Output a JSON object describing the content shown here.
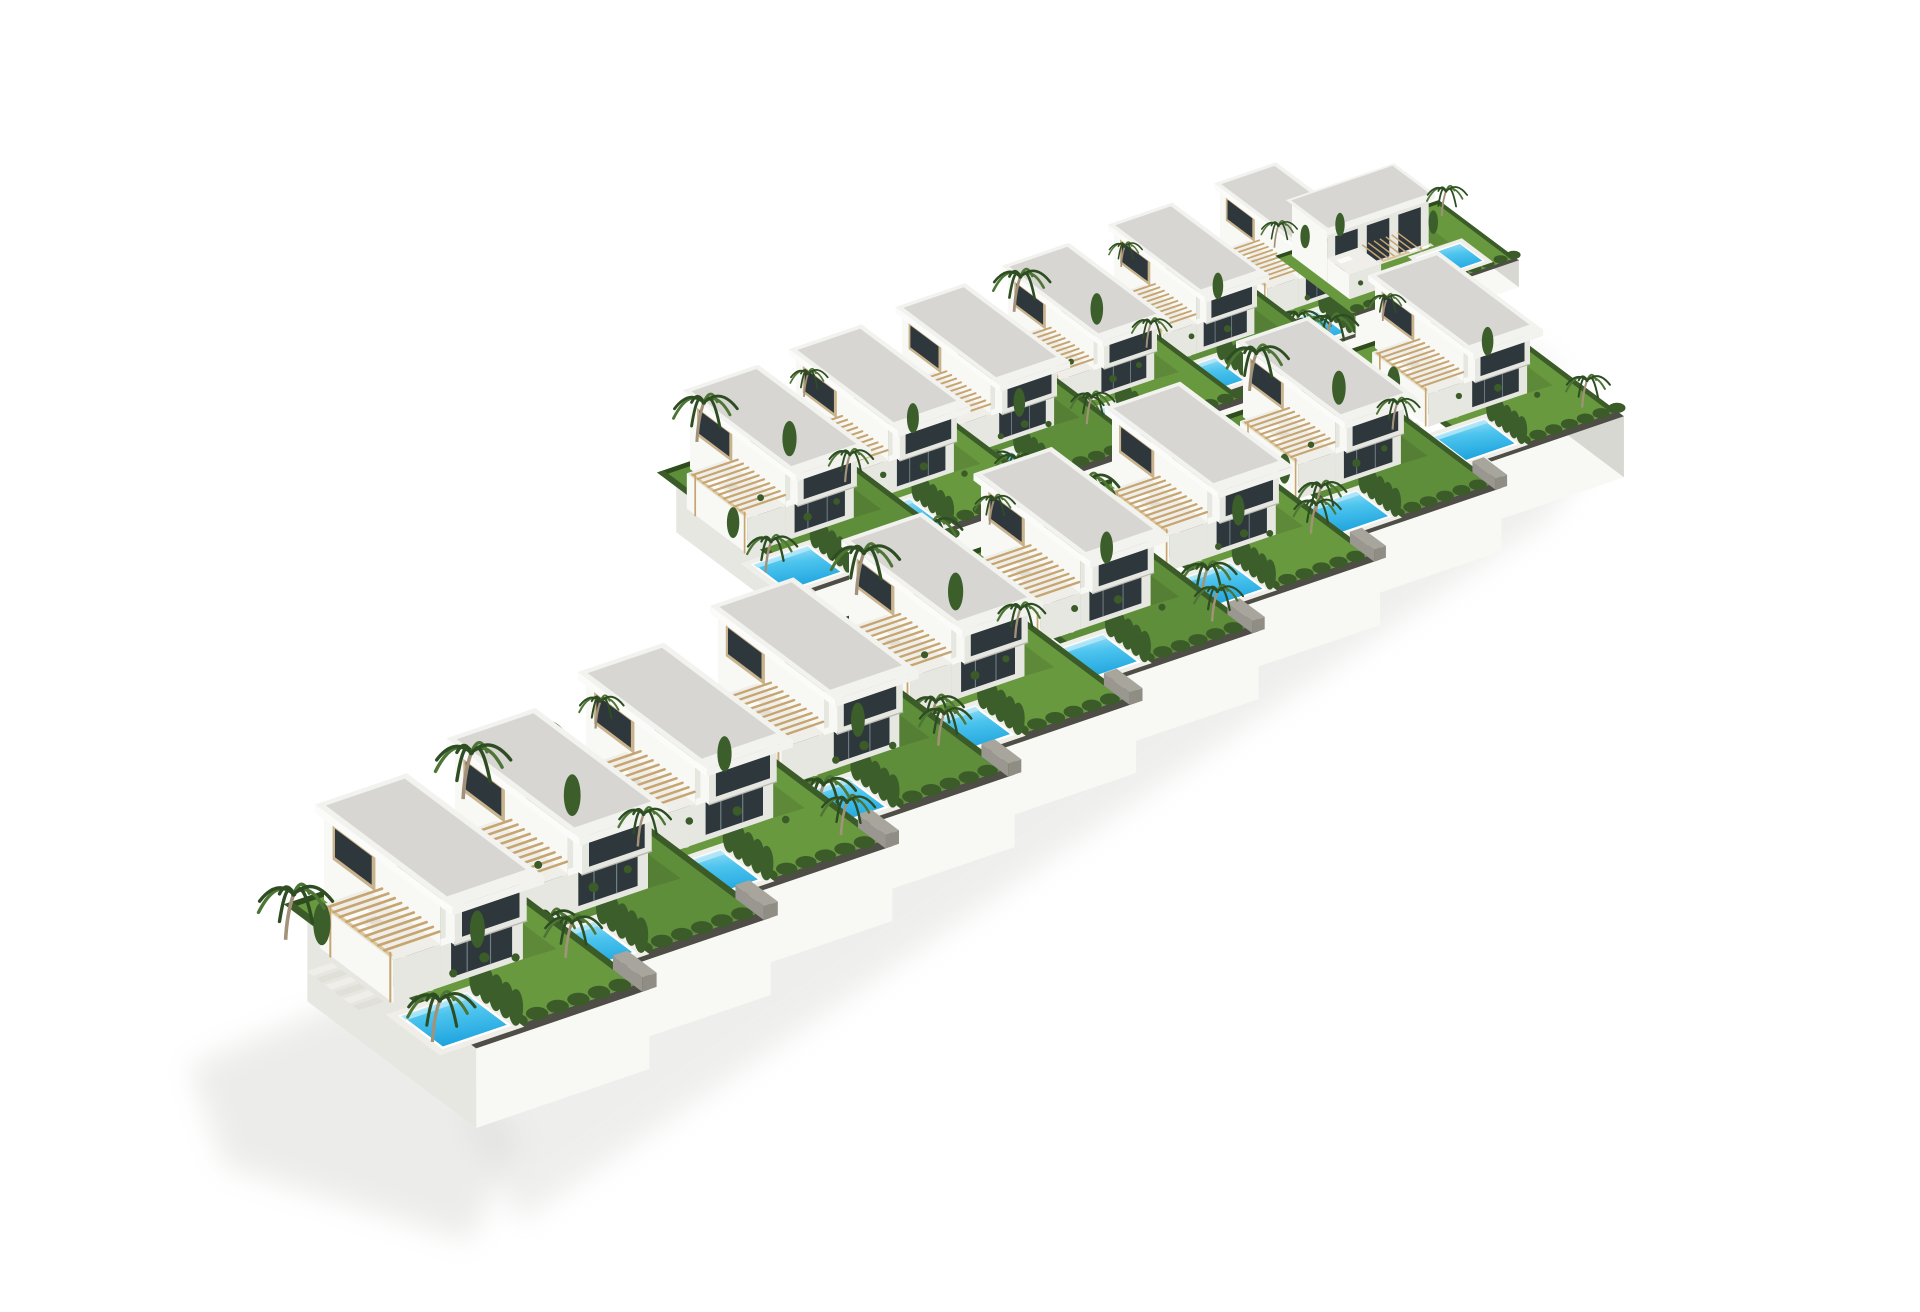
{
  "meta": {
    "description": "Aerial 3D architectural rendering of a terraced residential development on a white background: 16 modern white flat-roof villas arranged in two diagonal rows, each villa with a private garden, turquoise swimming pool, wooden pergola, roof terrace with white furniture, cypress hedges and palm trees, bounded by white retaining walls casting a soft shadow."
  },
  "scene": {
    "canvas": {
      "width": 1920,
      "height": 1280,
      "background": "#ffffff"
    },
    "axes": {
      "U": [
        0.88,
        -0.3
      ],
      "V": [
        0.6,
        0.45
      ]
    },
    "counts": {
      "villas": 16,
      "pools": 16,
      "front_row": 9,
      "back_row": 6,
      "rotated": 1
    },
    "colors": {
      "lawn_a": "#68993f",
      "lawn_b": "#5e8e3a",
      "hedge": "#3b5b29",
      "hedge_dark": "#2f4c1f",
      "cypress": "#3c5e2b",
      "palm_dark": "#2e4d23",
      "palm_mid": "#4d7534",
      "trunk": "#a3927a",
      "roof_gravel": "#d7d6d2",
      "parapet": "#f2f2ef",
      "wall_bright": "#f8f8f5",
      "wall_shade": "#e7e7e2",
      "wall_dark": "#d8d8d2",
      "glass": "#2e373b",
      "glass_light": "#8aa0a8",
      "frame": "#c8b38d",
      "deck": "#efeee8",
      "white": "#fbfbf9",
      "white_dim": "#e0dfd8",
      "pool_light": "#b5e8f8",
      "pool_mid": "#4cc4ee",
      "pool_deep": "#1ea4de",
      "wood": "#c7a571",
      "wood_light": "#ddc393",
      "gray_wall": "#8f8d84",
      "gray_wall_side": "#999790",
      "gray_wall_top": "#a7a59c",
      "gravel_strip": "#4e4e46",
      "shadow": "#d6d6d3"
    },
    "shadows": [
      {
        "points": [
          [
            150,
            1050
          ],
          [
            330,
            975
          ],
          [
            480,
            1120
          ],
          [
            430,
            1225
          ],
          [
            185,
            1150
          ]
        ],
        "opacity": 0.45
      },
      {
        "points": [
          [
            420,
            1095
          ],
          [
            1450,
            400
          ],
          [
            1550,
            445
          ],
          [
            1505,
            505
          ],
          [
            480,
            1205
          ]
        ],
        "opacity": 0.4
      },
      {
        "points": [
          [
            1380,
            305
          ],
          [
            1505,
            335
          ],
          [
            1530,
            375
          ],
          [
            1420,
            355
          ]
        ],
        "opacity": 0.28
      }
    ],
    "flora_sets": {
      "A": {
        "palms": [
          [
            -70,
            40,
            44
          ],
          [
            126,
            210,
            34
          ],
          [
            -62,
            268,
            40
          ]
        ],
        "cypress": [
          [
            -46,
            64,
            16
          ],
          [
            70,
            148,
            14
          ]
        ],
        "bushes": [
          [
            64,
            168,
            5
          ],
          [
            24,
            176,
            4
          ],
          [
            88,
            184,
            4
          ]
        ]
      },
      "B": {
        "palms": [
          [
            40,
            -45,
            46
          ],
          [
            128,
            120,
            32
          ],
          [
            -58,
            235,
            36
          ]
        ],
        "cypress": [
          [
            110,
            36,
            16
          ],
          [
            -44,
            150,
            14
          ]
        ],
        "bushes": [
          [
            50,
            160,
            5
          ],
          [
            96,
            150,
            4
          ],
          [
            30,
            96,
            4
          ]
        ]
      },
      "C": {
        "palms": [
          [
            -55,
            -25,
            40
          ],
          [
            128,
            255,
            34
          ],
          [
            44,
            -48,
            28
          ]
        ],
        "cypress": [
          [
            -48,
            110,
            16
          ],
          [
            104,
            88,
            14
          ]
        ],
        "bushes": [
          [
            70,
            160,
            5
          ],
          [
            20,
            150,
            4
          ],
          [
            100,
            200,
            4
          ]
        ]
      },
      "R": {
        "palms": [
          [
            248,
            26,
            38
          ],
          [
            64,
            176,
            30
          ],
          [
            -8,
            -34,
            34
          ]
        ],
        "cypress": [
          [
            30,
            -10,
            14
          ],
          [
            92,
            -10,
            14
          ],
          [
            210,
            60,
            14
          ]
        ],
        "bushes": [
          [
            120,
            170,
            5
          ],
          [
            40,
            120,
            4
          ]
        ]
      }
    },
    "villas": [
      {
        "id": "f0",
        "row": "front",
        "type": "standard",
        "anchor": [
          284,
          884
        ],
        "scale": 1.02,
        "wall_h": 78,
        "left_wall": true,
        "right_wall": false,
        "lawn": "a",
        "flora": "A"
      },
      {
        "id": "f1",
        "row": "front",
        "type": "standard",
        "anchor": [
          415,
          815
        ],
        "scale": 0.99,
        "wall_h": 78,
        "left_wall": false,
        "right_wall": false,
        "lawn": "b",
        "flora": "B"
      },
      {
        "id": "f2",
        "row": "front",
        "type": "standard",
        "anchor": [
          546,
          746
        ],
        "scale": 0.96,
        "wall_h": 78,
        "left_wall": false,
        "right_wall": false,
        "lawn": "a",
        "flora": "C"
      },
      {
        "id": "f3",
        "row": "front",
        "type": "standard",
        "anchor": [
          678,
          677
        ],
        "scale": 0.93,
        "wall_h": 78,
        "left_wall": false,
        "right_wall": false,
        "lawn": "b",
        "flora": "A"
      },
      {
        "id": "f4",
        "row": "front",
        "type": "standard",
        "anchor": [
          809,
          608
        ],
        "scale": 0.9,
        "wall_h": 78,
        "left_wall": false,
        "right_wall": false,
        "lawn": "a",
        "flora": "B"
      },
      {
        "id": "f5",
        "row": "front",
        "type": "standard",
        "anchor": [
          941,
          539
        ],
        "scale": 0.87,
        "wall_h": 78,
        "left_wall": false,
        "right_wall": false,
        "lawn": "b",
        "flora": "C"
      },
      {
        "id": "f6",
        "row": "front",
        "type": "standard",
        "anchor": [
          1072,
          470
        ],
        "scale": 0.84,
        "wall_h": 78,
        "left_wall": false,
        "right_wall": false,
        "lawn": "a",
        "flora": "A"
      },
      {
        "id": "f7",
        "row": "front",
        "type": "standard",
        "anchor": [
          1203,
          401
        ],
        "scale": 0.81,
        "wall_h": 78,
        "left_wall": false,
        "right_wall": false,
        "lawn": "b",
        "flora": "B"
      },
      {
        "id": "f8",
        "row": "front",
        "type": "standard",
        "anchor": [
          1335,
          332
        ],
        "scale": 0.78,
        "wall_h": 78,
        "left_wall": false,
        "right_wall": true,
        "lawn": "a",
        "flora": "C"
      },
      {
        "id": "b0",
        "row": "back",
        "type": "standard",
        "anchor": [
          650,
          453
        ],
        "scale": 0.84,
        "wall_h": 54,
        "left_wall": true,
        "right_wall": false,
        "lawn": "b",
        "flora": "B"
      },
      {
        "id": "b1",
        "row": "back",
        "type": "standard",
        "anchor": [
          756,
          409
        ],
        "scale": 0.81,
        "wall_h": 54,
        "left_wall": false,
        "right_wall": false,
        "lawn": "a",
        "flora": "C"
      },
      {
        "id": "b2",
        "row": "back",
        "type": "standard",
        "anchor": [
          862,
          364
        ],
        "scale": 0.78,
        "wall_h": 54,
        "left_wall": false,
        "right_wall": false,
        "lawn": "b",
        "flora": "A"
      },
      {
        "id": "b3",
        "row": "back",
        "type": "standard",
        "anchor": [
          968,
          320
        ],
        "scale": 0.75,
        "wall_h": 54,
        "left_wall": false,
        "right_wall": false,
        "lawn": "a",
        "flora": "B"
      },
      {
        "id": "b4",
        "row": "back",
        "type": "standard",
        "anchor": [
          1074,
          276
        ],
        "scale": 0.72,
        "wall_h": 54,
        "left_wall": false,
        "right_wall": false,
        "lawn": "b",
        "flora": "C"
      },
      {
        "id": "b5",
        "row": "back",
        "type": "standard",
        "anchor": [
          1180,
          232
        ],
        "scale": 0.69,
        "wall_h": 54,
        "left_wall": false,
        "right_wall": false,
        "lawn": "a",
        "flora": "A"
      },
      {
        "id": "r0",
        "row": "back",
        "type": "rotated",
        "anchor": [
          1252,
          240
        ],
        "scale": 0.64,
        "wall_h": 42,
        "left_wall": false,
        "right_wall": true,
        "lawn": "a",
        "flora": "R"
      }
    ]
  }
}
